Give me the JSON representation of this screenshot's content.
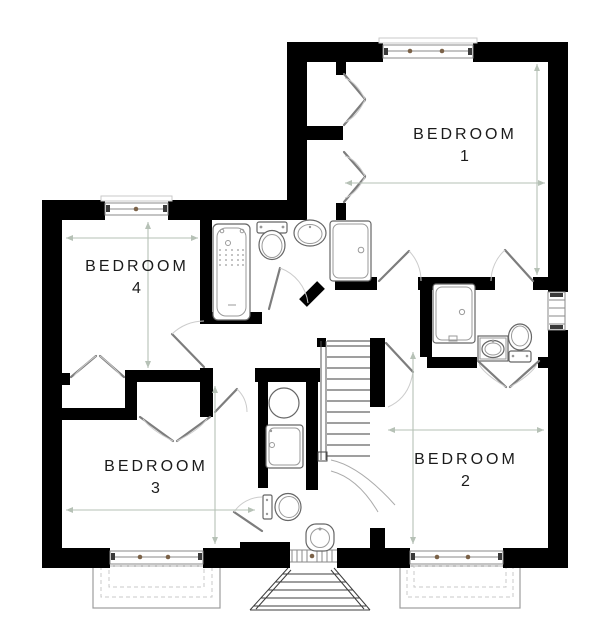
{
  "rooms": [
    {
      "id": "bedroom-1",
      "label": "BEDROOM",
      "number": "1"
    },
    {
      "id": "bedroom-2",
      "label": "BEDROOM",
      "number": "2"
    },
    {
      "id": "bedroom-3",
      "label": "BEDROOM",
      "number": "3"
    },
    {
      "id": "bedroom-4",
      "label": "BEDROOM",
      "number": "4"
    }
  ],
  "fixtures": [
    {
      "name": "bathtub-icon",
      "room": "bathroom"
    },
    {
      "name": "toilet-icon",
      "room": "bathroom"
    },
    {
      "name": "basin-icon",
      "room": "bathroom"
    },
    {
      "name": "shower-icon",
      "room": "bathroom"
    },
    {
      "name": "shower-icon",
      "room": "ensuite"
    },
    {
      "name": "vanity-basin-icon",
      "room": "ensuite"
    },
    {
      "name": "toilet-icon",
      "room": "ensuite"
    },
    {
      "name": "round-basin-icon",
      "room": "shower-room"
    },
    {
      "name": "shower-icon",
      "room": "shower-room"
    },
    {
      "name": "toilet-icon",
      "room": "shower-room"
    },
    {
      "name": "pedestal-basin-icon",
      "room": "shower-room"
    },
    {
      "name": "staircase-icon",
      "room": "landing"
    }
  ],
  "colors": {
    "background": "#ffffff",
    "wall": "#000000",
    "fixture_outline": "#666666",
    "dimension_line": "#b6c1b6",
    "window_hinge": "#7b6248",
    "label_text": "#1b1b1b"
  }
}
